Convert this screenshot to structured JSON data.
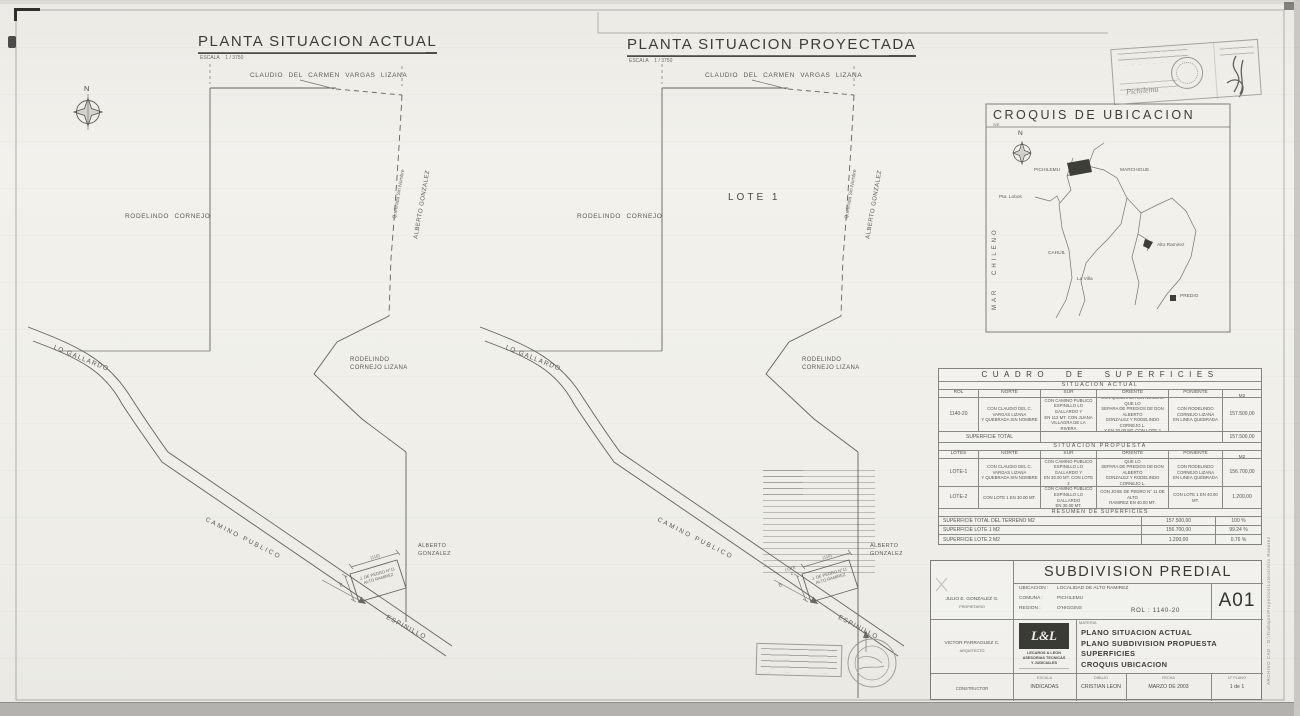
{
  "plan_actual": {
    "title": "PLANTA SITUACION ACTUAL",
    "scale_label": "ESCALA",
    "scale_value": "1 / 3750",
    "owner_top": "CLAUDIO DEL CARMEN VARGAS LIZANA",
    "owner_left": "RODELINDO CORNEJO",
    "quebrada": "Quebrada Sin Nombre",
    "owner_right": "ALBERTO GONZALEZ",
    "owner_center": "RODELINDO\nCORNEJO LIZANA",
    "road_upper": "LO GALLARDO",
    "road_main": "CAMINO PUBLICO",
    "road_lower": "ESPINILLO",
    "small_lot": "J. DE PEDRO N°11\nALTO RAMIREZ",
    "owner_southeast": "ALBERTO\nGONZALEZ",
    "dim_width": "(110)",
    "dim_height": "40",
    "north": "N"
  },
  "plan_proyectada": {
    "title": "PLANTA SITUACION PROYECTADA",
    "scale_label": "ESCALA",
    "scale_value": "1 / 3750",
    "owner_top": "CLAUDIO DEL CARMEN VARGAS LIZANA",
    "owner_left": "RODELINDO CORNEJO",
    "lote1": "LOTE 1",
    "lote2": "LOTE\n2",
    "quebrada": "Quebrada Sin Nombre",
    "owner_right": "ALBERTO GONZALEZ",
    "owner_center": "RODELINDO\nCORNEJO LIZANA",
    "road_upper": "LO GALLARDO",
    "road_main": "CAMINO PUBLICO",
    "road_lower": "ESPINILLO",
    "small_lot": "J. DE PEDRO N°11\nALTO RAMIREZ",
    "owner_southeast": "ALBERTO\nGONZALEZ",
    "dim_width": "(110)",
    "dim_height": "40"
  },
  "croquis": {
    "title": "CROQUIS DE UBICACION",
    "scale": "S/E",
    "north": "N",
    "sea": "MAR CHILENO",
    "towns": {
      "pichilemu": "PICHILEMU",
      "marchigue": "MARCHIGUE",
      "pta_lobos": "Pta. Lobos",
      "cahuil": "CAHUIL",
      "la_villa": "La Villa",
      "alto_ramirez": "Alto Ramirez"
    },
    "legend": "PREDIO"
  },
  "cuadro": {
    "title": "CUADRO DE SUPERFICIES",
    "actual_section": "SITUACION ACTUAL",
    "headers_actual": [
      "ROL",
      "NORTE",
      "SUR",
      "ORIENTE",
      "PONIENTE",
      "SUPERFICIE M2"
    ],
    "actual_rol": "1140-20",
    "actual_norte": "CON CLAUDIO DEL C. VARGAS LIZANA\nY QUEBRADA SIN NOMBRE",
    "actual_sur": "CON CAMINO PUBLICO\nESPINILLO LO GALLARDO Y\nEN 112 MT. CON JUANA\nVILLAGRA DE LA RIVERA",
    "actual_oriente": "CON QUEBRADA SIN NOMBRE QUE LO\nSEPARA DE PREDIOS DE DON ALBERTO\nGONZALEZ Y RODELINDO CORNEJO L.\nY EN 30.00 MT. CON LOTE 2",
    "actual_poniente": "CON RODELINDO CORNEJO LIZANA\nEN LINEA QUEBRADA",
    "actual_superficie": "157.500,00",
    "total_label": "SUPERFICIE TOTAL",
    "total_value": "157.500,00",
    "propuesta_section": "SITUACION PROPUESTA",
    "headers_propuesta": [
      "LOTES",
      "NORTE",
      "SUR",
      "ORIENTE",
      "PONIENTE",
      "SUPERFICIE M2"
    ],
    "lote1_id": "LOTE-1",
    "lote1_norte": "CON CLAUDIO DEL C. VARGAS LIZANA\nY QUEBRADA SIN NOMBRE",
    "lote1_sur": "CON CAMINO PUBLICO\nESPINILLO LO GALLARDO Y\nEN 30.00 MT. CON LOTE 2",
    "lote1_oriente": "CON QUEBRADA SIN NOMBRE QUE LO\nSEPARA DE PREDIOS DE DON ALBERTO\nGONZALEZ Y RODELINDO CORNEJO L.\nY EN 40.00 MT. CON LOTE 2",
    "lote1_poniente": "CON RODELINDO CORNEJO LIZANA\nEN LINEA QUEBRADA",
    "lote1_superficie": "156.700,00",
    "lote2_id": "LOTE-2",
    "lote2_norte": "CON LOTE 1 EN 30.00 MT.",
    "lote2_sur": "CON CAMINO PUBLICO\nESPINILLO LO GALLARDO\nEN 30.00 MT.",
    "lote2_oriente": "CON JOSE DE PEDRO N° 11 DE ALTO\nRAMIREZ EN 40.00 MT.",
    "lote2_poniente": "CON LOTE 1 EN 40.00 MT.",
    "lote2_superficie": "1.200,00",
    "resumen_title": "RESUMEN DE SUPERFICIES",
    "resumen": [
      {
        "label": "SUPERFICIE TOTAL DEL TERRENO M2",
        "value": "157.500,00",
        "pct": "100 %"
      },
      {
        "label": "SUPERFICIE LOTE 1 M2",
        "value": "156.700,00",
        "pct": "99.24 %"
      },
      {
        "label": "SUPERFICIE LOTE 2 M2",
        "value": "1.200,00",
        "pct": "0.76 %"
      }
    ]
  },
  "titleblock": {
    "title": "SUBDIVISION PREDIAL",
    "sheet": "A01",
    "ubicacion_label": "UBICACION :",
    "ubicacion": "LOCALIDAD DE ALTO RAMIREZ",
    "comuna_label": "COMUNA :",
    "comuna": "PICHILEMU",
    "region_label": "REGION :",
    "region": "O'HIGGINS",
    "rol": "ROL : 1140-20",
    "propietario_name": "JULIO E. GONZALEZ G.",
    "propietario_role": "PROPIETARIO",
    "arquitecto_name": "VICTOR PARRAGUEZ C.",
    "arquitecto_role": "ARQUITECTO",
    "constructor_role": "CONSTRUCTOR",
    "logo_mark": "L&L",
    "logo_firm": "LECAROS & LEON\nASESORIAS TECNICAS\nY JUDICIALES",
    "materia_label": "MATERIA",
    "materia": "PLANO SITUACION ACTUAL\nPLANO SUBDIVISION PROPUESTA\nSUPERFICIES\nCROQUIS UBICACION",
    "escala_label": "ESCALA",
    "escala": "INDICADAS",
    "dibujo_label": "DIBUJO",
    "dibujo": "CRISTIAN LEON",
    "fecha_label": "FECHA",
    "fecha": "MARZO DE 2003",
    "nplano_label": "N° PLANO",
    "nplano": "1 de 1"
  },
  "margin_note": "ARCHIVO CAD : D:\\Trabajos\\Proyectos\\Loteos\\Alto Ramirez",
  "stamp_note": "Pichilemu"
}
